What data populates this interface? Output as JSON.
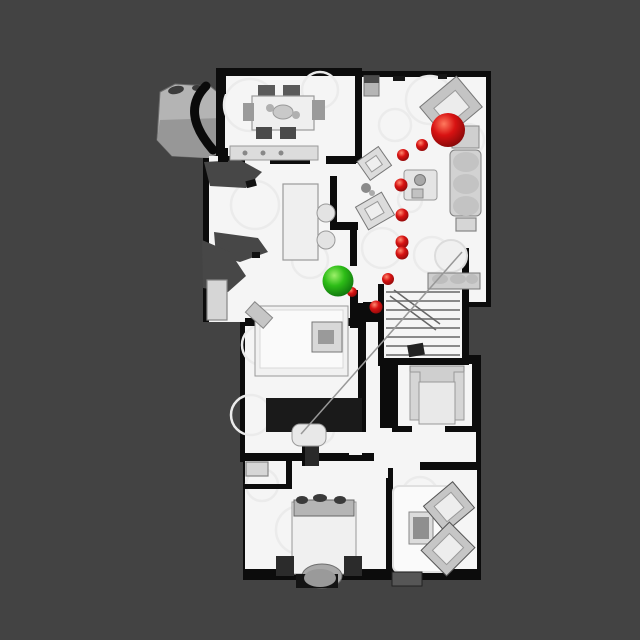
{
  "scene": {
    "description": "Top-down rendered floorplan of a scanned multi-room apartment with navigation markers (green start sphere, red goal sphere, red waypoint path)",
    "background_color": "#434343",
    "floor_color": "#f5f5f5",
    "wall_color": "#0c0c0c",
    "unscanned_color": "#474747",
    "canvas": {
      "width": 640,
      "height": 640
    }
  },
  "markers": {
    "goal": {
      "label": "goal-sphere",
      "x": 448,
      "y": 130,
      "r": 17,
      "color": "#d81212",
      "highlight": "#ff7a5e",
      "shadow": "#7e0808"
    },
    "agent": {
      "label": "start-sphere",
      "x": 338,
      "y": 281,
      "r": 15.5,
      "color": "#2dbd17",
      "highlight": "#9df06a",
      "shadow": "#0d6e0d"
    },
    "path": {
      "color": "#d81212",
      "highlight": "#ff8a70",
      "shadow": "#8a0a0a",
      "points": [
        {
          "x": 422,
          "y": 145,
          "r": 6.0
        },
        {
          "x": 403,
          "y": 155,
          "r": 6.0
        },
        {
          "x": 401,
          "y": 185,
          "r": 6.5
        },
        {
          "x": 402,
          "y": 215,
          "r": 6.5
        },
        {
          "x": 402,
          "y": 242,
          "r": 6.5
        },
        {
          "x": 402,
          "y": 253,
          "r": 6.5
        },
        {
          "x": 388,
          "y": 279,
          "r": 6.0
        },
        {
          "x": 352,
          "y": 292,
          "r": 5.0
        },
        {
          "x": 376,
          "y": 307,
          "r": 6.5
        }
      ]
    }
  }
}
